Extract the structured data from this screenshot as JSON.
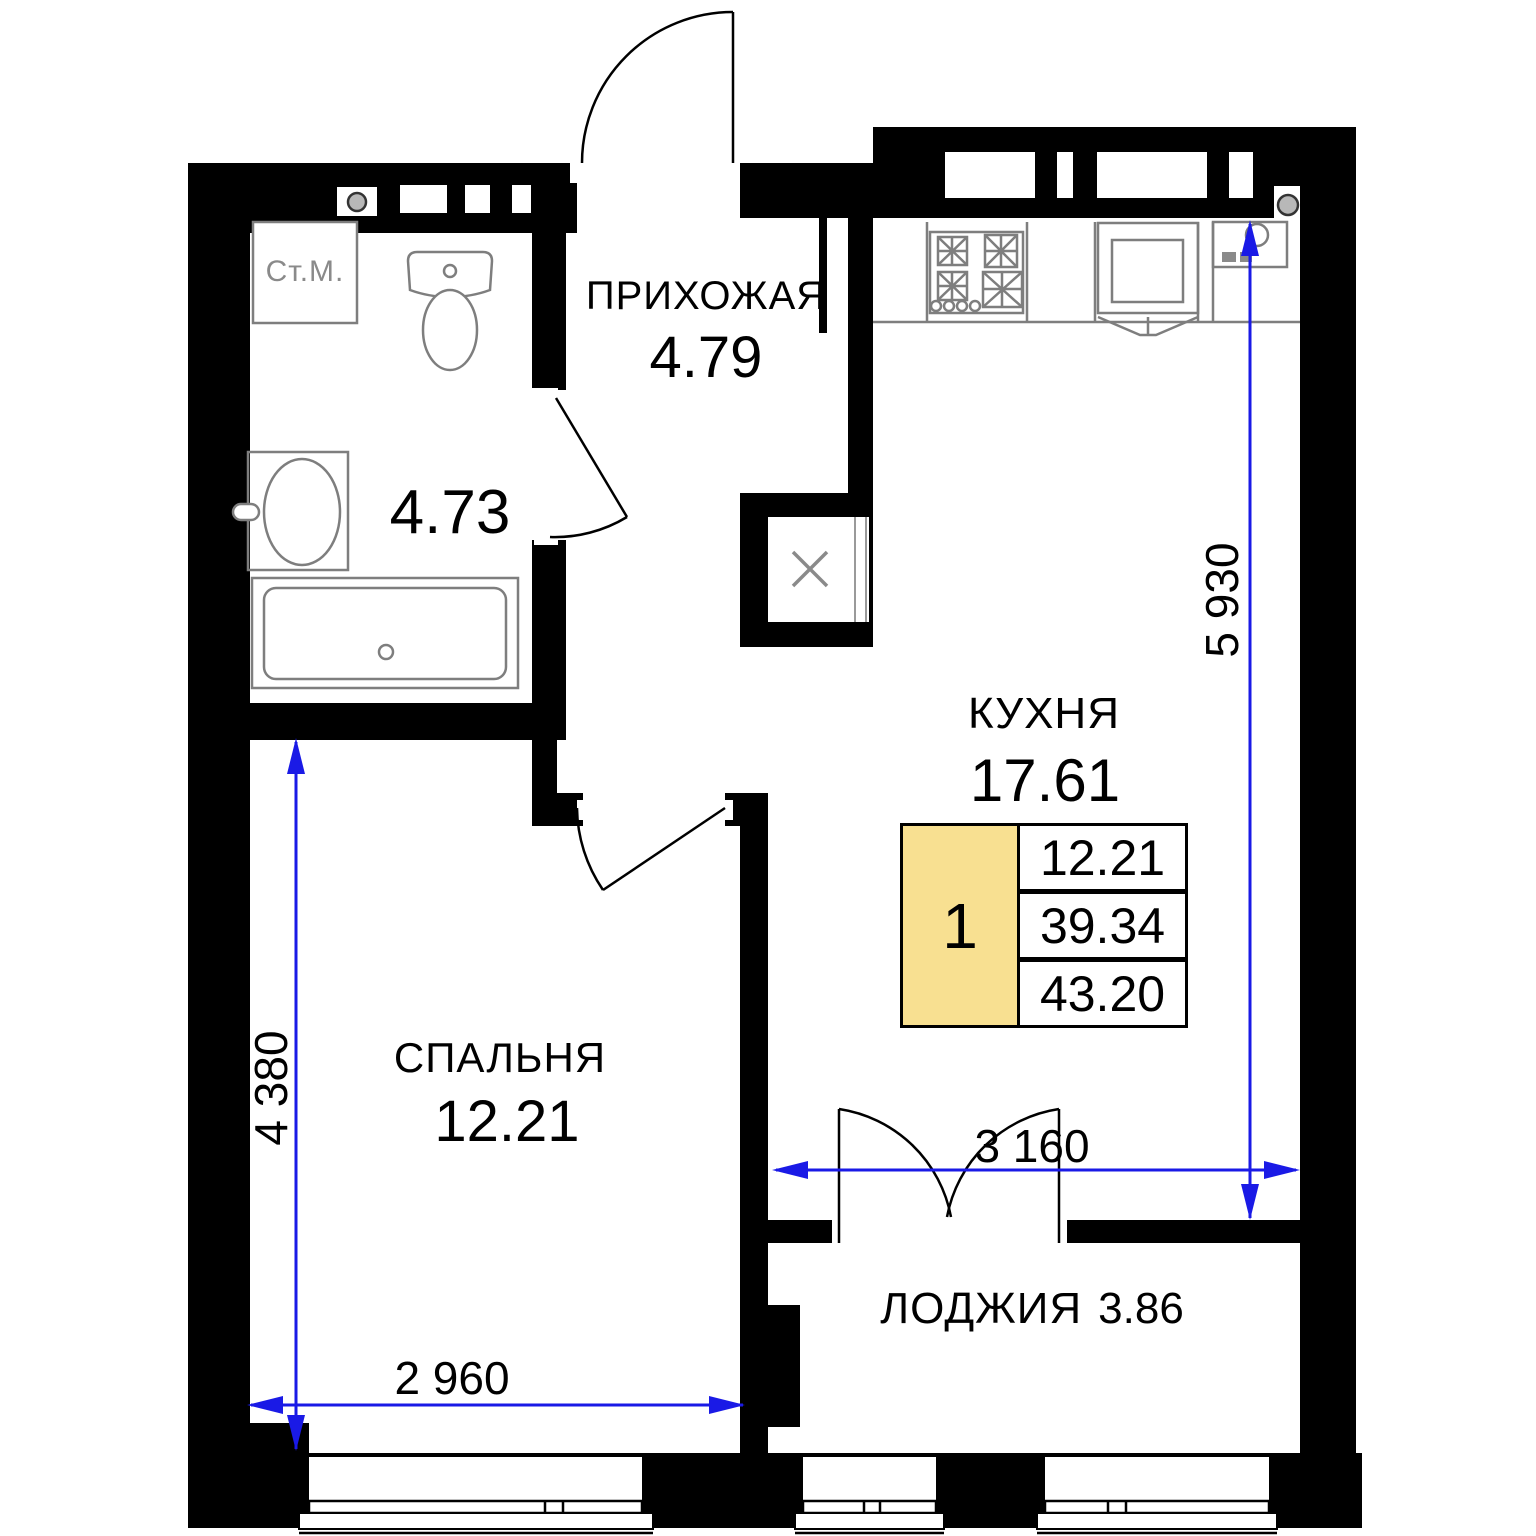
{
  "colors": {
    "wall": "#000000",
    "dim": "#1a1ae6",
    "fixture": "#7e7e7e",
    "yellow": "#f8e091",
    "pipe": "#b8b8b8"
  },
  "rooms": {
    "hallway": {
      "name": "ПРИХОЖАЯ",
      "area": "4.79"
    },
    "bathroom": {
      "area": "4.73"
    },
    "kitchen": {
      "name": "КУХНЯ",
      "area": "17.61"
    },
    "bedroom": {
      "name": "СПАЛЬНЯ",
      "area": "12.21"
    },
    "loggia": {
      "name": "ЛОДЖИЯ",
      "area": "3.86"
    }
  },
  "legend": {
    "rooms_count": "1",
    "living_area": "12.21",
    "area_no_loggia": "39.34",
    "total_area": "43.20"
  },
  "dimensions": {
    "kitchen_height": "5 930",
    "bedroom_height": "4 380",
    "loggia_width": "3 160",
    "bedroom_width": "2 960"
  },
  "fixtures": {
    "washing_machine_label": "Ст.М."
  }
}
